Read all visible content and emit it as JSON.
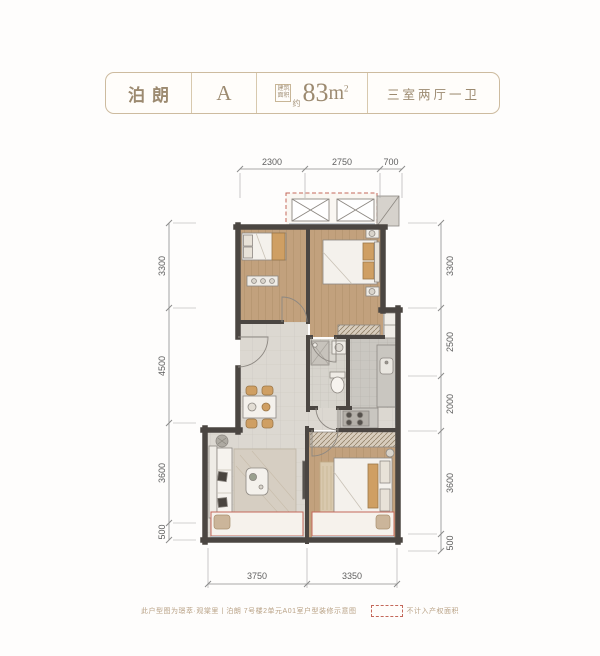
{
  "header": {
    "project_name": "泊朗",
    "unit_label": "A",
    "area_prefix_line1": "建筑",
    "area_prefix_line2": "面积",
    "area_approx": "约",
    "area_number": "83",
    "area_unit": "m",
    "area_superscript": "2",
    "layout_label": "三室两厅一卫"
  },
  "plan": {
    "type": "floorplan",
    "dimensions": {
      "top": [
        "2300",
        "2750",
        "700"
      ],
      "left": [
        "3300",
        "4500",
        "3600",
        "500"
      ],
      "right": [
        "3300",
        "2500",
        "2000",
        "3600",
        "500"
      ],
      "bottom": [
        "3750",
        "3350"
      ]
    }
  },
  "footer": {
    "disclaimer": "此户型图为璟萃·观棠里丨泊朗 7号楼2单元A01室户型装修示意图",
    "legend_label": "不计入产权面积"
  },
  "colors": {
    "accent_red": "#c4685a",
    "wall_dark": "#4b4642",
    "wood_floor": "#c2a17d",
    "tile_floor": "#dcd8d1",
    "header_text": "#9c8a70",
    "header_border": "#cdbb9f",
    "dimension_text": "#5f5f5f",
    "window_glass": "#b9c2c8"
  }
}
